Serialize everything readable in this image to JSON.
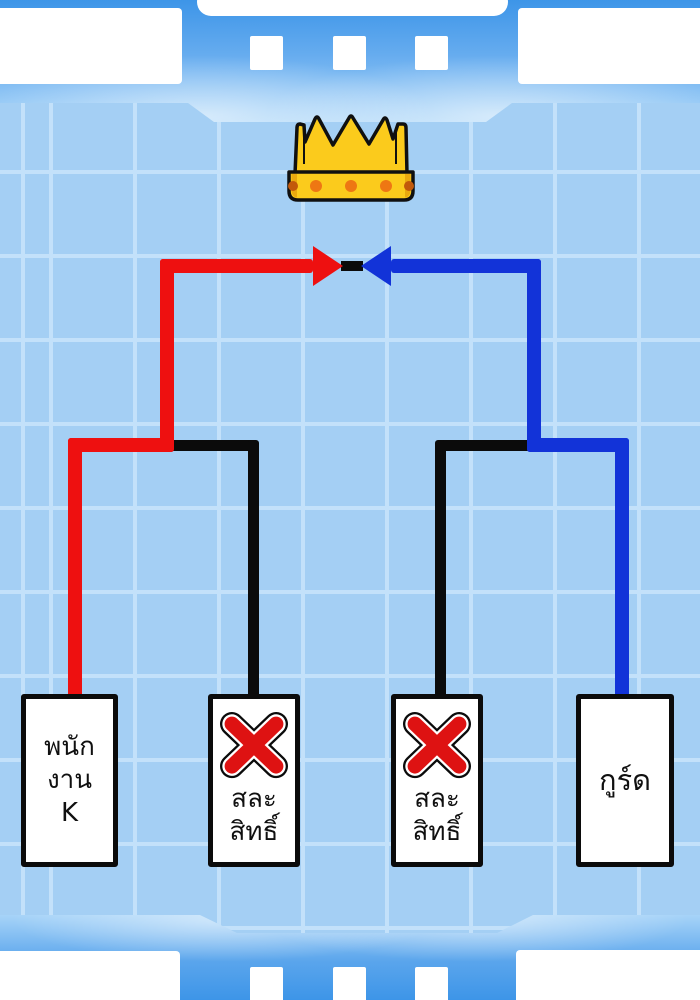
{
  "diagram_type": "tournament-bracket",
  "colors": {
    "background": "#A4CFF4",
    "grid_line": "#C3E1FA",
    "frame_blue_dark": "#3D95E8",
    "frame_blue_light": "#A7D4F8",
    "winner_left": "#EE1010",
    "winner_right": "#1233D8",
    "eliminated": "#0B0B0B",
    "crown_gold": "#FBCB1C",
    "crown_gold_dark": "#E9A90F",
    "crown_dot": "#EE7713",
    "crown_dot_dark": "#C2590A",
    "x_red": "#DE1212",
    "box_bg": "#FFFFFF",
    "box_border": "#0B0B0B",
    "text": "#101010"
  },
  "final": {
    "prize_icon": "crown-icon",
    "left_arrow_color_name": "red",
    "right_arrow_color_name": "blue"
  },
  "participants": [
    {
      "full_label": "พนักงาน K",
      "label_lines": [
        "พนัก",
        "งาน",
        "K"
      ],
      "path_color_name": "red",
      "x_mark": false,
      "advanced_to_final": true
    },
    {
      "full_label": "สละสิทธิ์",
      "label_lines": [
        "สละ",
        "สิทธิ์"
      ],
      "path_color_name": "black",
      "x_mark": true,
      "advanced_to_final": false
    },
    {
      "full_label": "สละสิทธิ์",
      "label_lines": [
        "สละ",
        "สิทธิ์"
      ],
      "path_color_name": "black",
      "x_mark": true,
      "advanced_to_final": false
    },
    {
      "full_label": "กูร์ด",
      "label_lines": [
        "กูร์ด"
      ],
      "path_color_name": "blue",
      "x_mark": false,
      "advanced_to_final": true
    }
  ]
}
